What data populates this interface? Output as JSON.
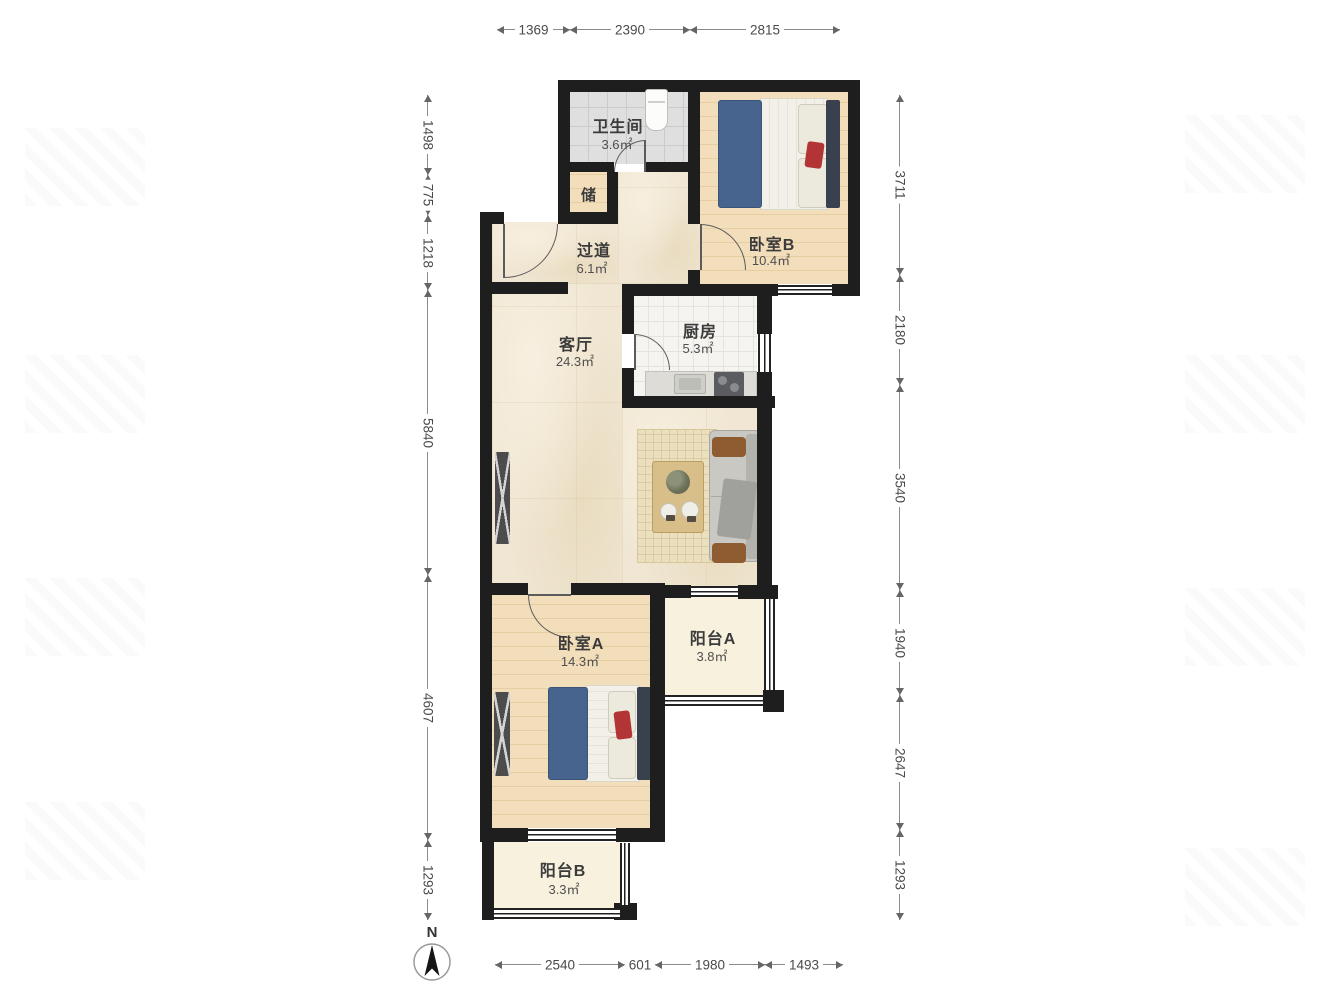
{
  "north_label": "N",
  "rooms": {
    "bathroom": {
      "name": "卫生间",
      "area": "3.6㎡"
    },
    "storage": {
      "name": "储"
    },
    "hallway": {
      "name": "过道",
      "area": "6.1㎡"
    },
    "bedroom_b": {
      "name": "卧室B",
      "area": "10.4㎡"
    },
    "kitchen": {
      "name": "厨房",
      "area": "5.3㎡"
    },
    "living_room": {
      "name": "客厅",
      "area": "24.3㎡"
    },
    "bedroom_a": {
      "name": "卧室A",
      "area": "14.3㎡"
    },
    "balcony_a": {
      "name": "阳台A",
      "area": "3.8㎡"
    },
    "balcony_b": {
      "name": "阳台B",
      "area": "3.3㎡"
    }
  },
  "dimensions_mm": {
    "top": [
      "1369",
      "2390",
      "2815"
    ],
    "left": [
      "1498",
      "775",
      "1218",
      "5840",
      "4607",
      "1293"
    ],
    "right": [
      "3711",
      "2180",
      "3540",
      "1940",
      "2647",
      "1293"
    ],
    "bottom": [
      "2540",
      "601",
      "1980",
      "1493"
    ]
  },
  "colors": {
    "wall": "#1e1e1e",
    "wood_floor": "#f3debc",
    "marble_floor": "#f0e6d3",
    "bath_tile": "#dfdfdf",
    "kitchen_tile": "#f5f4f1",
    "balcony_floor": "#f8f1de",
    "bed_blue": "#47648e",
    "accent_red": "#b23434"
  }
}
